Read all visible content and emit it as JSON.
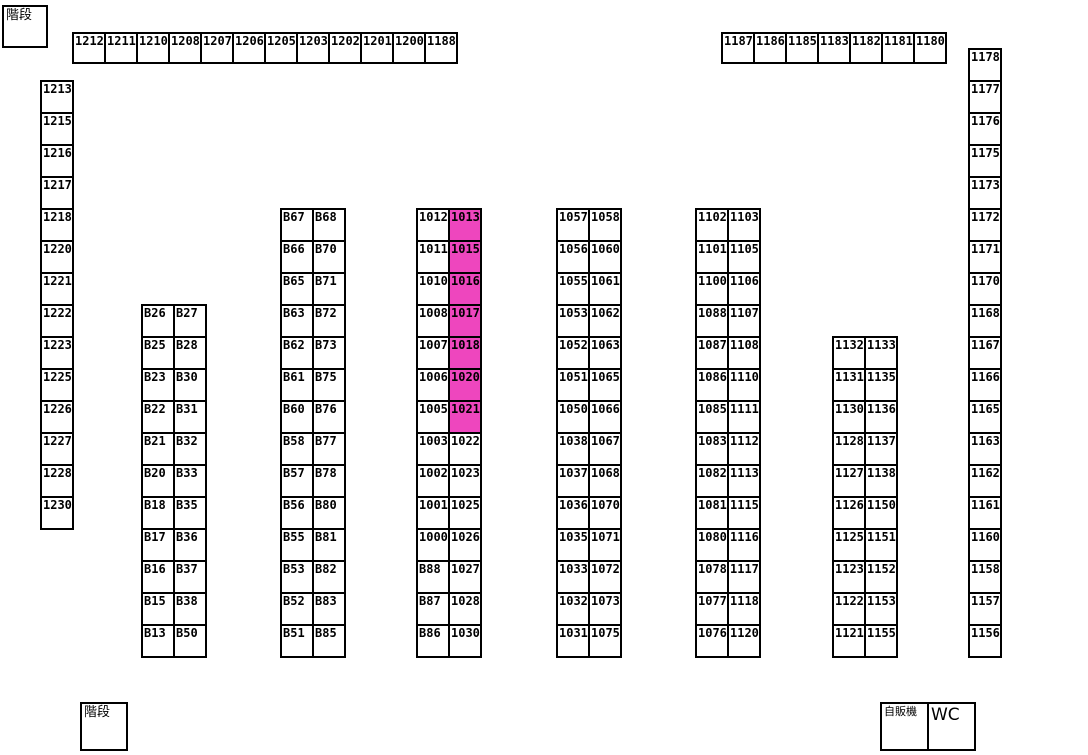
{
  "map": {
    "highlight_color": "#ee46be",
    "labels": {
      "stairs_top": "階段",
      "stairs_bottom": "階段",
      "vending": "自販機",
      "wc": "WC"
    },
    "strips": [
      {
        "name": "top-row-left",
        "orient": "h",
        "x": 72,
        "y": 32,
        "step": 32,
        "cell_w": 32,
        "cell_h": 30,
        "cells": [
          "1212",
          "1211",
          "1210",
          "1208",
          "1207",
          "1206",
          "1205",
          "1203",
          "1202",
          "1201",
          "1200",
          "1188"
        ]
      },
      {
        "name": "top-row-right",
        "orient": "h",
        "x": 721,
        "y": 32,
        "step": 32,
        "cell_w": 32,
        "cell_h": 30,
        "cells": [
          "1187",
          "1186",
          "1185",
          "1183",
          "1182",
          "1181",
          "1180"
        ]
      },
      {
        "name": "left-column",
        "orient": "v",
        "x": 40,
        "y": 80,
        "step": 32,
        "cell_w": 32,
        "cell_h": 32,
        "cells": [
          "1213",
          "1215",
          "1216",
          "1217",
          "1218",
          "1220",
          "1221",
          "1222",
          "1223",
          "1225",
          "1226",
          "1227",
          "1228",
          "1230"
        ]
      },
      {
        "name": "right-column",
        "orient": "v",
        "x": 968,
        "y": 48,
        "step": 32,
        "cell_w": 32,
        "cell_h": 32,
        "cells": [
          "1178",
          "1177",
          "1176",
          "1175",
          "1173",
          "1172",
          "1171",
          "1170",
          "1168",
          "1167",
          "1166",
          "1165",
          "1163",
          "1162",
          "1161",
          "1160",
          "1158",
          "1157",
          "1156"
        ]
      }
    ],
    "blocks": [
      {
        "name": "block-b13-b50",
        "x": 141,
        "y": 304,
        "col_step": 32,
        "row_step": 32,
        "highlight": [],
        "rows": [
          [
            "B26",
            "B27"
          ],
          [
            "B25",
            "B28"
          ],
          [
            "B23",
            "B30"
          ],
          [
            "B22",
            "B31"
          ],
          [
            "B21",
            "B32"
          ],
          [
            "B20",
            "B33"
          ],
          [
            "B18",
            "B35"
          ],
          [
            "B17",
            "B36"
          ],
          [
            "B16",
            "B37"
          ],
          [
            "B15",
            "B38"
          ],
          [
            "B13",
            "B50"
          ]
        ]
      },
      {
        "name": "block-b51-b85",
        "x": 280,
        "y": 208,
        "col_step": 32,
        "row_step": 32,
        "highlight": [],
        "rows": [
          [
            "B67",
            "B68"
          ],
          [
            "B66",
            "B70"
          ],
          [
            "B65",
            "B71"
          ],
          [
            "B63",
            "B72"
          ],
          [
            "B62",
            "B73"
          ],
          [
            "B61",
            "B75"
          ],
          [
            "B60",
            "B76"
          ],
          [
            "B58",
            "B77"
          ],
          [
            "B57",
            "B78"
          ],
          [
            "B56",
            "B80"
          ],
          [
            "B55",
            "B81"
          ],
          [
            "B53",
            "B82"
          ],
          [
            "B52",
            "B83"
          ],
          [
            "B51",
            "B85"
          ]
        ]
      },
      {
        "name": "block-1000-1030",
        "x": 416,
        "y": 208,
        "col_step": 32,
        "row_step": 32,
        "highlight": [
          "1013",
          "1015",
          "1016",
          "1017",
          "1018",
          "1020",
          "1021"
        ],
        "rows": [
          [
            "1012",
            "1013"
          ],
          [
            "1011",
            "1015"
          ],
          [
            "1010",
            "1016"
          ],
          [
            "1008",
            "1017"
          ],
          [
            "1007",
            "1018"
          ],
          [
            "1006",
            "1020"
          ],
          [
            "1005",
            "1021"
          ],
          [
            "1003",
            "1022"
          ],
          [
            "1002",
            "1023"
          ],
          [
            "1001",
            "1025"
          ],
          [
            "1000",
            "1026"
          ],
          [
            "B88",
            "1027"
          ],
          [
            "B87",
            "1028"
          ],
          [
            "B86",
            "1030"
          ]
        ]
      },
      {
        "name": "block-1031-1075",
        "x": 556,
        "y": 208,
        "col_step": 32,
        "row_step": 32,
        "highlight": [],
        "rows": [
          [
            "1057",
            "1058"
          ],
          [
            "1056",
            "1060"
          ],
          [
            "1055",
            "1061"
          ],
          [
            "1053",
            "1062"
          ],
          [
            "1052",
            "1063"
          ],
          [
            "1051",
            "1065"
          ],
          [
            "1050",
            "1066"
          ],
          [
            "1038",
            "1067"
          ],
          [
            "1037",
            "1068"
          ],
          [
            "1036",
            "1070"
          ],
          [
            "1035",
            "1071"
          ],
          [
            "1033",
            "1072"
          ],
          [
            "1032",
            "1073"
          ],
          [
            "1031",
            "1075"
          ]
        ]
      },
      {
        "name": "block-1076-1120",
        "x": 695,
        "y": 208,
        "col_step": 32,
        "row_step": 32,
        "highlight": [],
        "rows": [
          [
            "1102",
            "1103"
          ],
          [
            "1101",
            "1105"
          ],
          [
            "1100",
            "1106"
          ],
          [
            "1088",
            "1107"
          ],
          [
            "1087",
            "1108"
          ],
          [
            "1086",
            "1110"
          ],
          [
            "1085",
            "1111"
          ],
          [
            "1083",
            "1112"
          ],
          [
            "1082",
            "1113"
          ],
          [
            "1081",
            "1115"
          ],
          [
            "1080",
            "1116"
          ],
          [
            "1078",
            "1117"
          ],
          [
            "1077",
            "1118"
          ],
          [
            "1076",
            "1120"
          ]
        ]
      },
      {
        "name": "block-1121-1155",
        "x": 832,
        "y": 336,
        "col_step": 32,
        "row_step": 32,
        "highlight": [],
        "rows": [
          [
            "1132",
            "1133"
          ],
          [
            "1131",
            "1135"
          ],
          [
            "1130",
            "1136"
          ],
          [
            "1128",
            "1137"
          ],
          [
            "1127",
            "1138"
          ],
          [
            "1126",
            "1150"
          ],
          [
            "1125",
            "1151"
          ],
          [
            "1123",
            "1152"
          ],
          [
            "1122",
            "1153"
          ],
          [
            "1121",
            "1155"
          ]
        ]
      }
    ]
  }
}
